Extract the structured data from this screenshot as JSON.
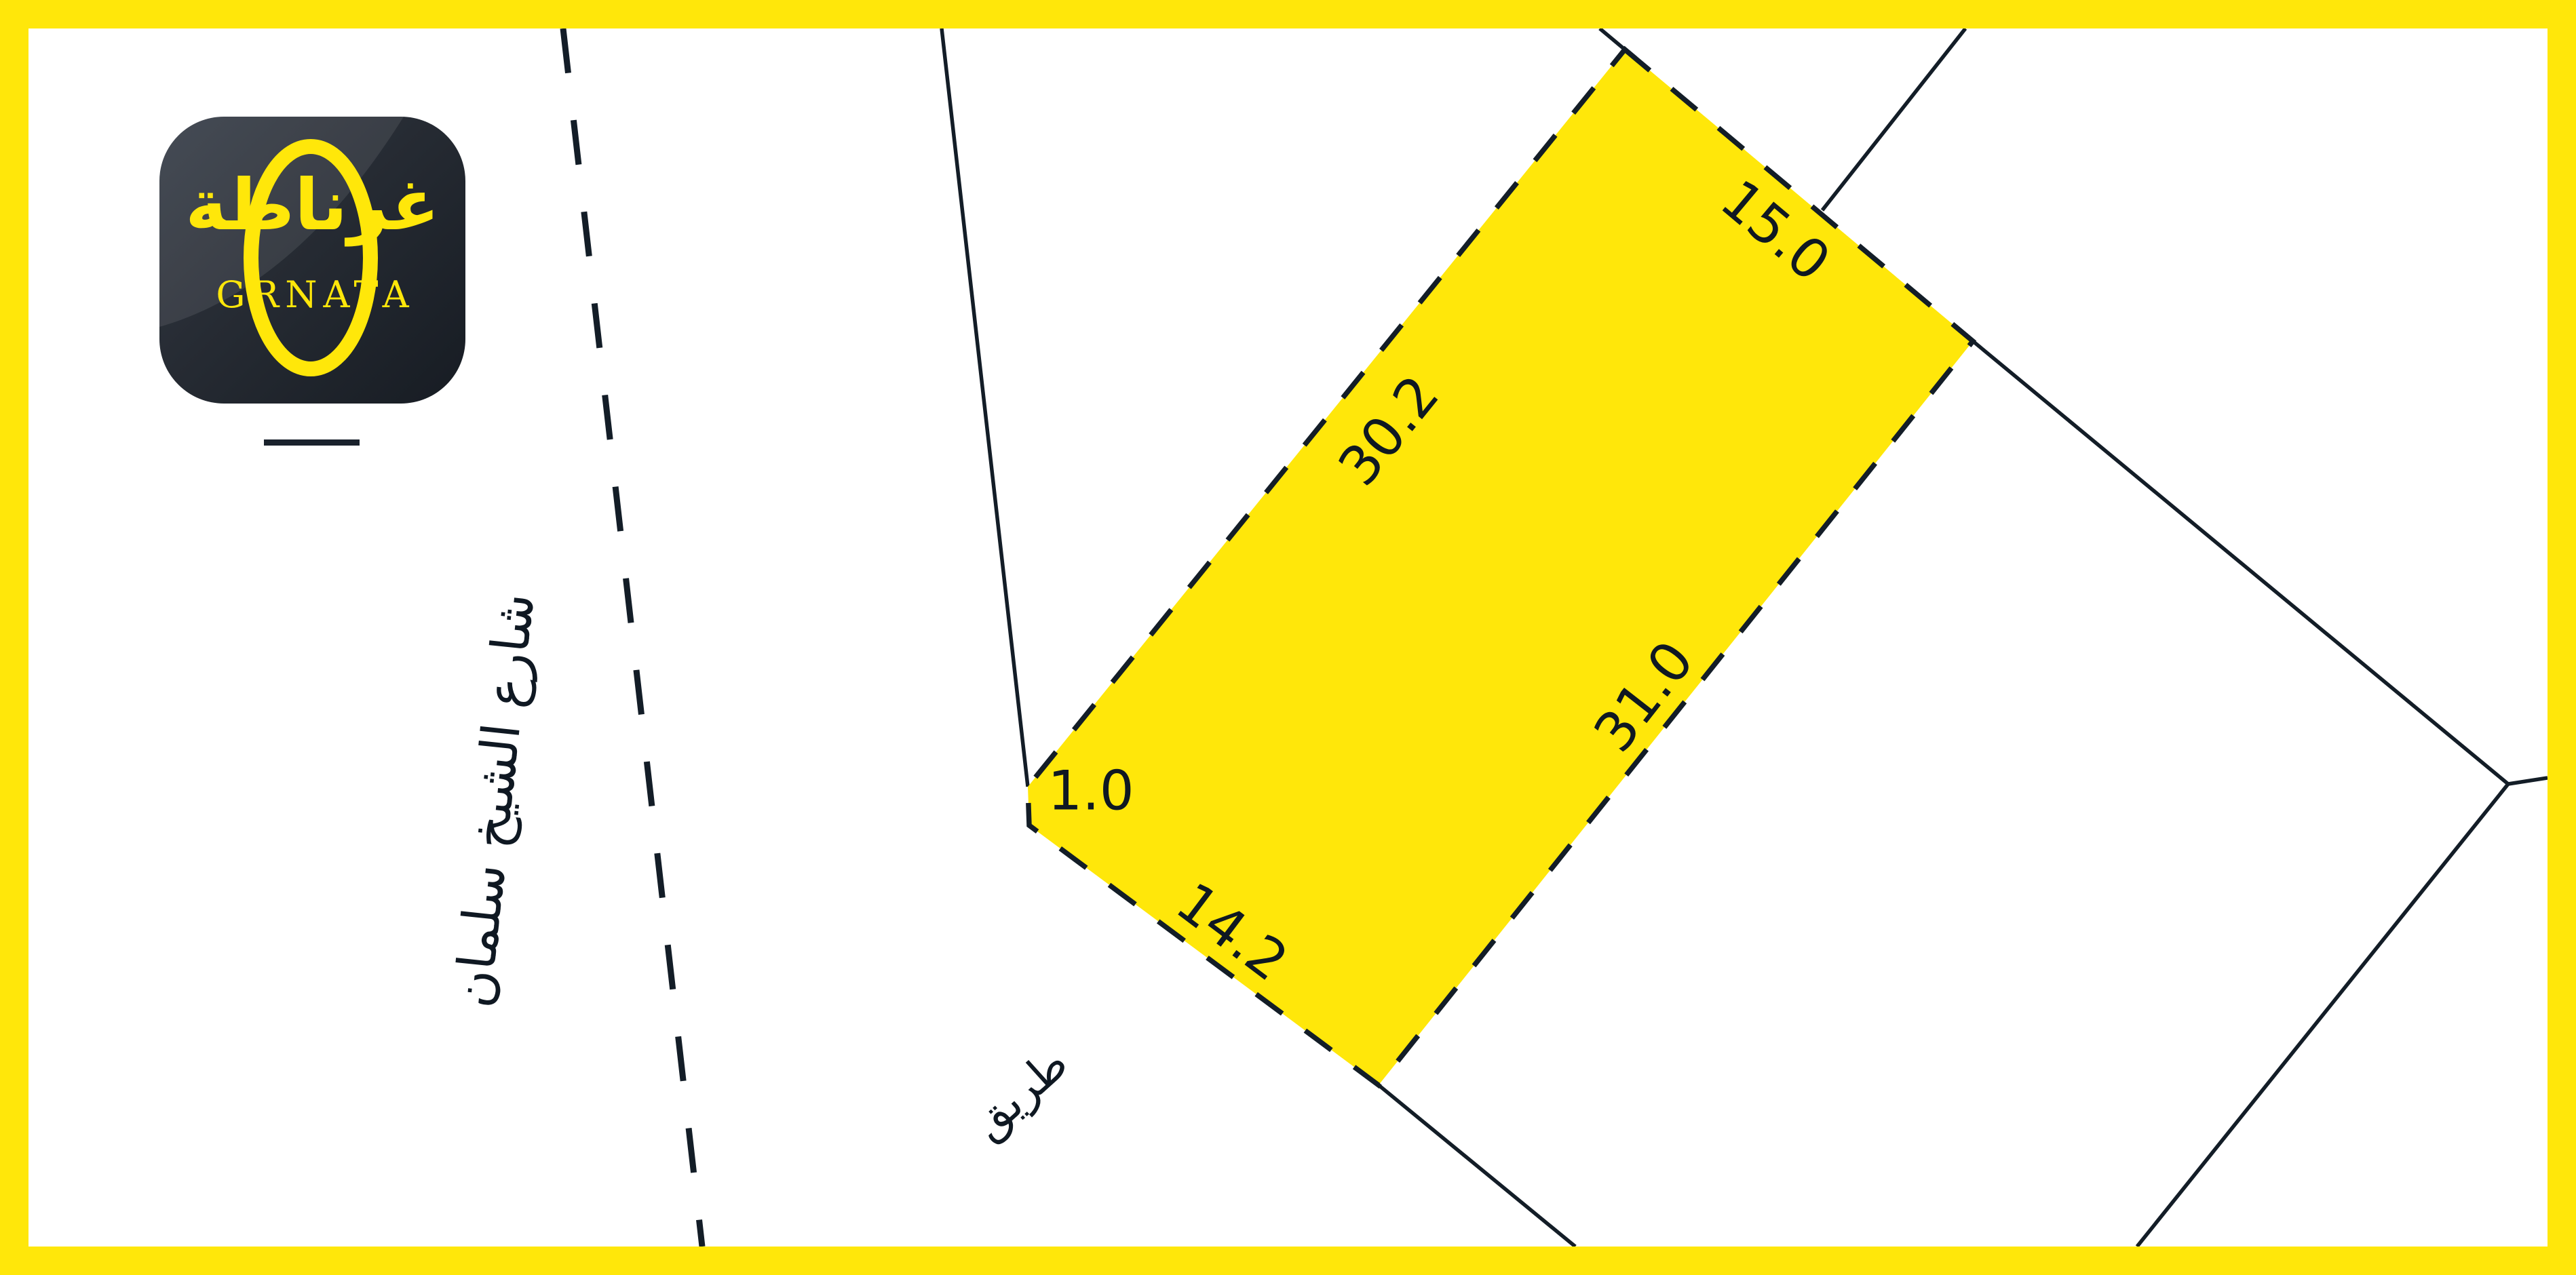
{
  "brand": {
    "arabic_name": "غرناطة",
    "latin_name": "GRNATA"
  },
  "labels": {
    "street_name": "شارع الشيخ سلمان",
    "road": "طريق"
  },
  "plot": {
    "fill_color": "#FFE70A",
    "dimensions": {
      "top_edge": "15.0",
      "upper_left_edge": "30.2",
      "lower_right_edge": "31.0",
      "bottom_edge": "14.2",
      "chamfer_edge": "1.0"
    }
  },
  "colors": {
    "accent_yellow": "#FFE70A",
    "ink": "#131D27",
    "logo_background": "#262B33"
  }
}
